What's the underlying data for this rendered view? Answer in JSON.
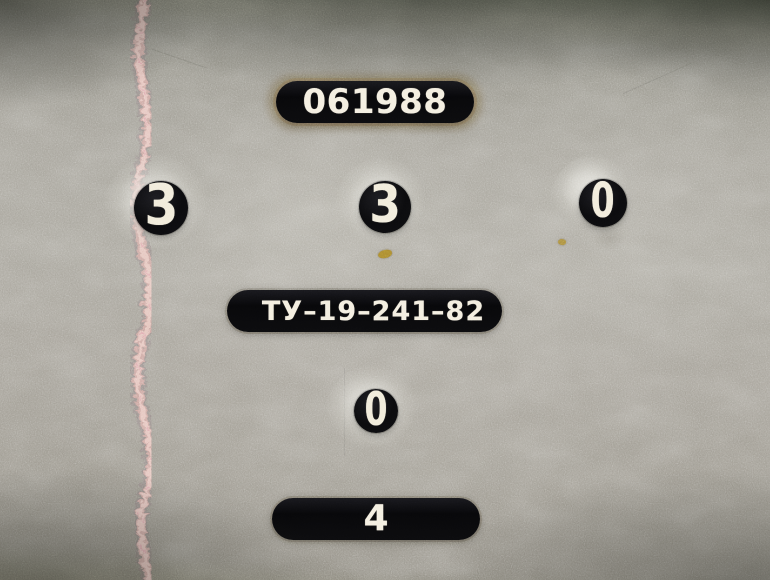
{
  "panel": {
    "serial_plate": {
      "text": "061988"
    },
    "counters": {
      "left": {
        "value": "3"
      },
      "middle": {
        "value": "3"
      },
      "right": {
        "value": "0"
      },
      "lower": {
        "value": "0"
      }
    },
    "spec_plate": {
      "text": "ТУ–19–241–82"
    },
    "bottom_plate": {
      "text": "4"
    }
  },
  "colors": {
    "metal_base": "#a5a29a",
    "metal_dark_edge": "#565a4e",
    "plate_black": "#0b0b0d",
    "lettering_white": "#f2ecdc",
    "seam_pink": "#cda69f",
    "seam_highlight": "#e8c8c0",
    "brass_fleck": "#a8862f",
    "halo_sheen": "#e8e7e1"
  }
}
